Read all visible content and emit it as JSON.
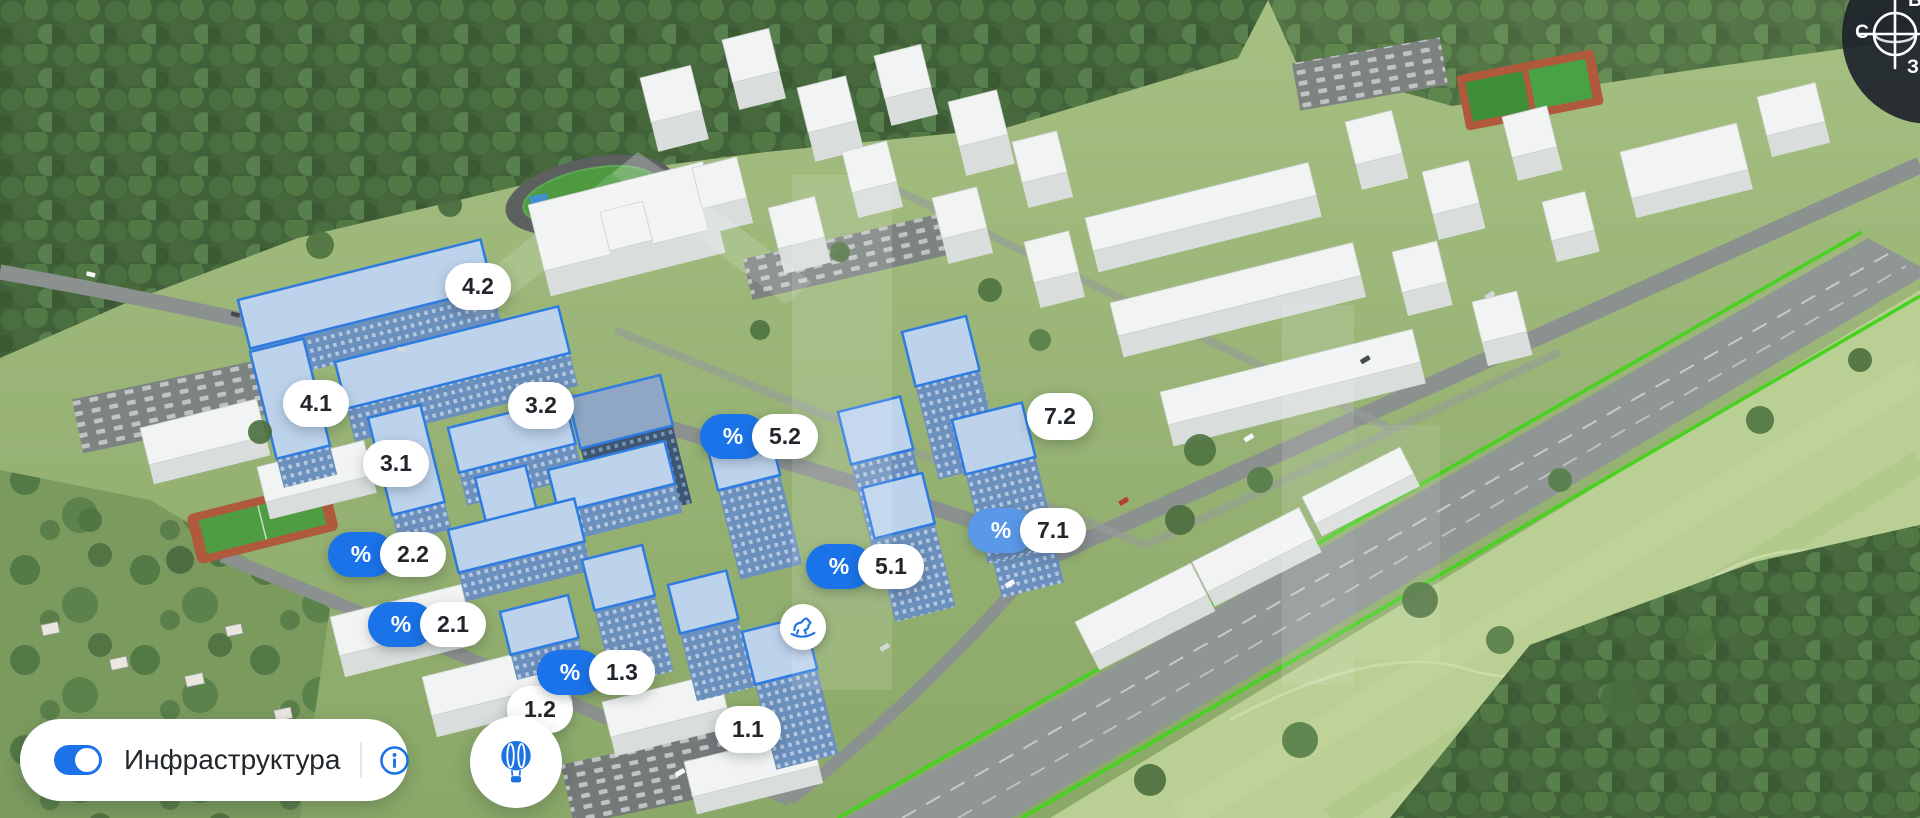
{
  "map": {
    "percent_symbol": "%",
    "markers": [
      {
        "name": "building-4.2",
        "label": "4.2",
        "discount": false
      },
      {
        "name": "building-4.1",
        "label": "4.1",
        "discount": false
      },
      {
        "name": "building-3.2",
        "label": "3.2",
        "discount": false
      },
      {
        "name": "building-3.1",
        "label": "3.1",
        "discount": false
      },
      {
        "name": "building-5.2",
        "label": "5.2",
        "discount": true
      },
      {
        "name": "building-7.2",
        "label": "7.2",
        "discount": false
      },
      {
        "name": "building-2.2",
        "label": "2.2",
        "discount": true
      },
      {
        "name": "building-7.1",
        "label": "7.1",
        "discount": true
      },
      {
        "name": "building-5.1",
        "label": "5.1",
        "discount": true
      },
      {
        "name": "building-2.1",
        "label": "2.1",
        "discount": true
      },
      {
        "name": "building-1.3",
        "label": "1.3",
        "discount": true
      },
      {
        "name": "building-1.2",
        "label": "1.2",
        "discount": false
      },
      {
        "name": "building-1.1",
        "label": "1.1",
        "discount": false
      }
    ],
    "poi": {
      "playground_icon": "rocking-horse-icon"
    }
  },
  "toolbar": {
    "infrastructure_label": "Инфраструктура",
    "toggle_state": "on",
    "info_icon": "info-icon",
    "balloon_icon": "hot-air-balloon-icon"
  },
  "compass": {
    "north_label": "С",
    "west_label": "З",
    "east_label": "В"
  },
  "colors": {
    "accent_blue": "#1A73E8",
    "badge_light_blue": "#5A98E8",
    "building_outline_blue": "#2E7CE1",
    "highway_green_line": "#46D21F",
    "marker_text": "#20262C"
  }
}
